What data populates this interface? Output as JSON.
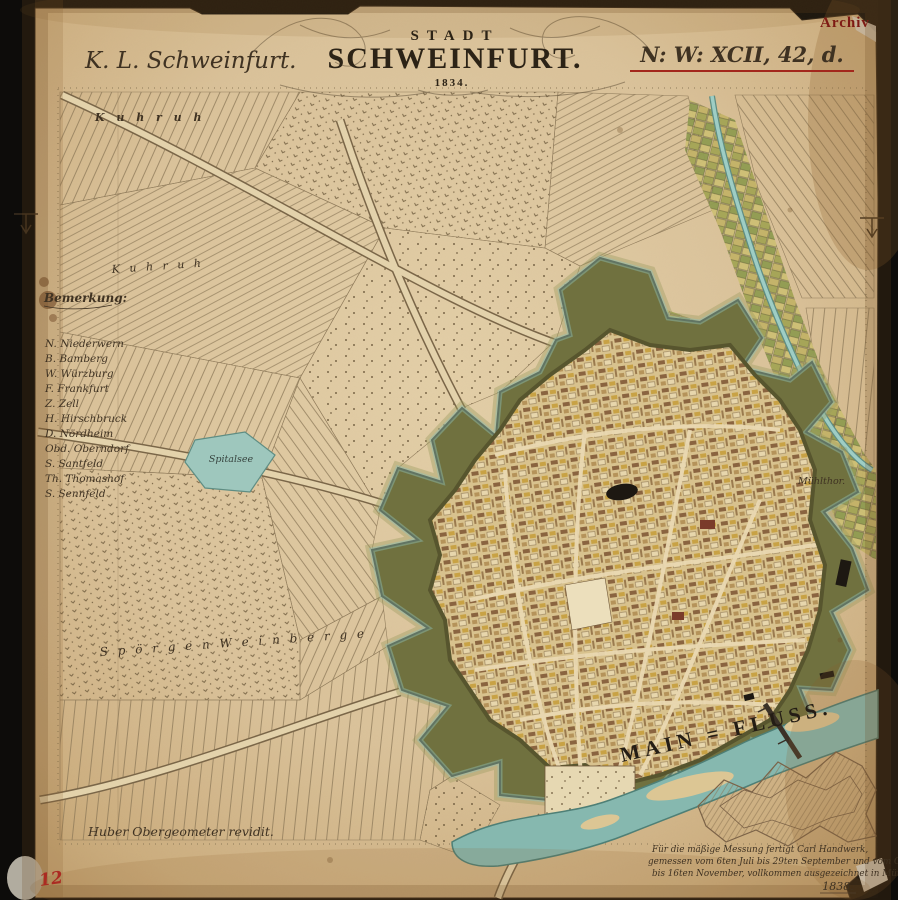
{
  "header": {
    "archive_stamp": "Archiv",
    "district_title": "K. L. Schweinfurt.",
    "catalog_ref": "N: W: XCII, 42, d.",
    "title_top": "STADT",
    "title_main": "SCHWEINFURT.",
    "title_year": "1834."
  },
  "legend": {
    "heading": "Bemerkung:",
    "items": [
      "N. Niederwern",
      "B. Bamberg",
      "W. Würzburg",
      "F. Frankfurt",
      "Z. Zell",
      "H. Hirschbruck",
      "D. Nördheim",
      "Obd. Oberndorf",
      "S. Santfeld",
      "Th. Thomashof",
      "S. Sennfeld"
    ]
  },
  "map_labels": {
    "field_nw": "K u h r u h",
    "field_nw2": "K u h r u h",
    "lake": "Spitalsee",
    "mill_gate": "Mühlthor.",
    "vineyard_sw": "S p ö r g e n   W e i n b e r g e",
    "river": "MAIN = FLUSS."
  },
  "footer": {
    "surveyor_note": "Huber Obergeometer revidit.",
    "sheet_number": "12",
    "survey_note_line1": "Für die mäßige Messung fertigt Carl Handwerk,",
    "survey_note_line2": "gemessen vom 6ten Juli bis 29ten September und vom October",
    "survey_note_line3": "bis 16ten November, vollkommen ausgezeichnet in München.",
    "survey_note_year": "1838."
  },
  "colors": {
    "accent_red": "#9e2a1f",
    "fortification_green": "#6f7040",
    "water_teal": "#8abbb1",
    "paper": "#d9c29a",
    "ink_brown": "#4a3a28",
    "photo_background": "#0d0c0a"
  }
}
